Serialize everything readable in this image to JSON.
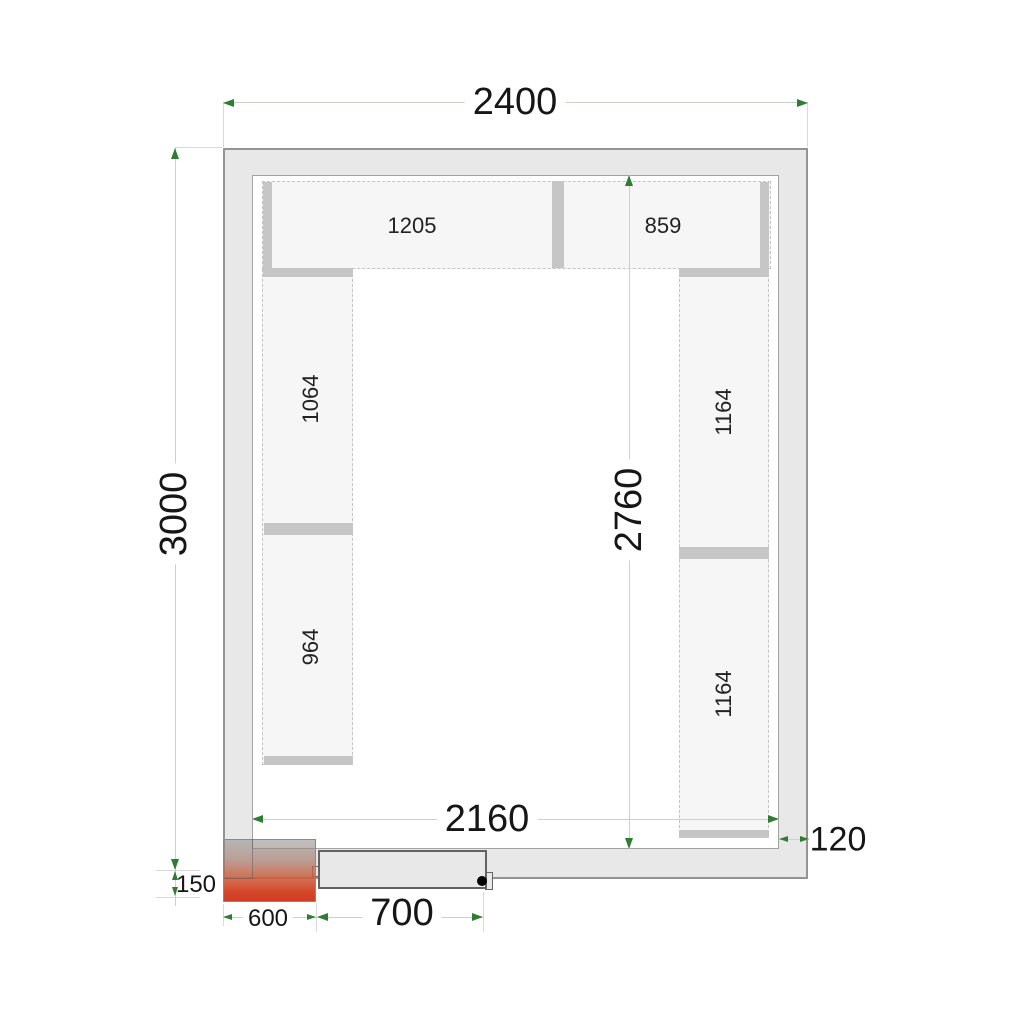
{
  "drawing": {
    "type": "cold-room floor plan, top view",
    "dims": {
      "total_width": "2400",
      "total_height": "3000",
      "clear_width": "2160",
      "clear_height": "2760",
      "wall_thickness": "120",
      "door_width": "700",
      "unit_width": "600",
      "unit_offset": "150"
    },
    "shelves": {
      "top_left": "1205",
      "top_right": "859",
      "left_upper": "1064",
      "left_lower": "964",
      "right_upper": "1164",
      "right_lower": "1164"
    },
    "colors": {
      "wall_fill": "#e8e8e8",
      "shelf_fill": "#f6f6f6",
      "shelf_bar": "#c6c6c6",
      "dimension_arrow_green": "#2e7d32",
      "dimension_line": "#c9d4c9",
      "monoblock_red": "#d03c22",
      "text": "#161616"
    }
  }
}
